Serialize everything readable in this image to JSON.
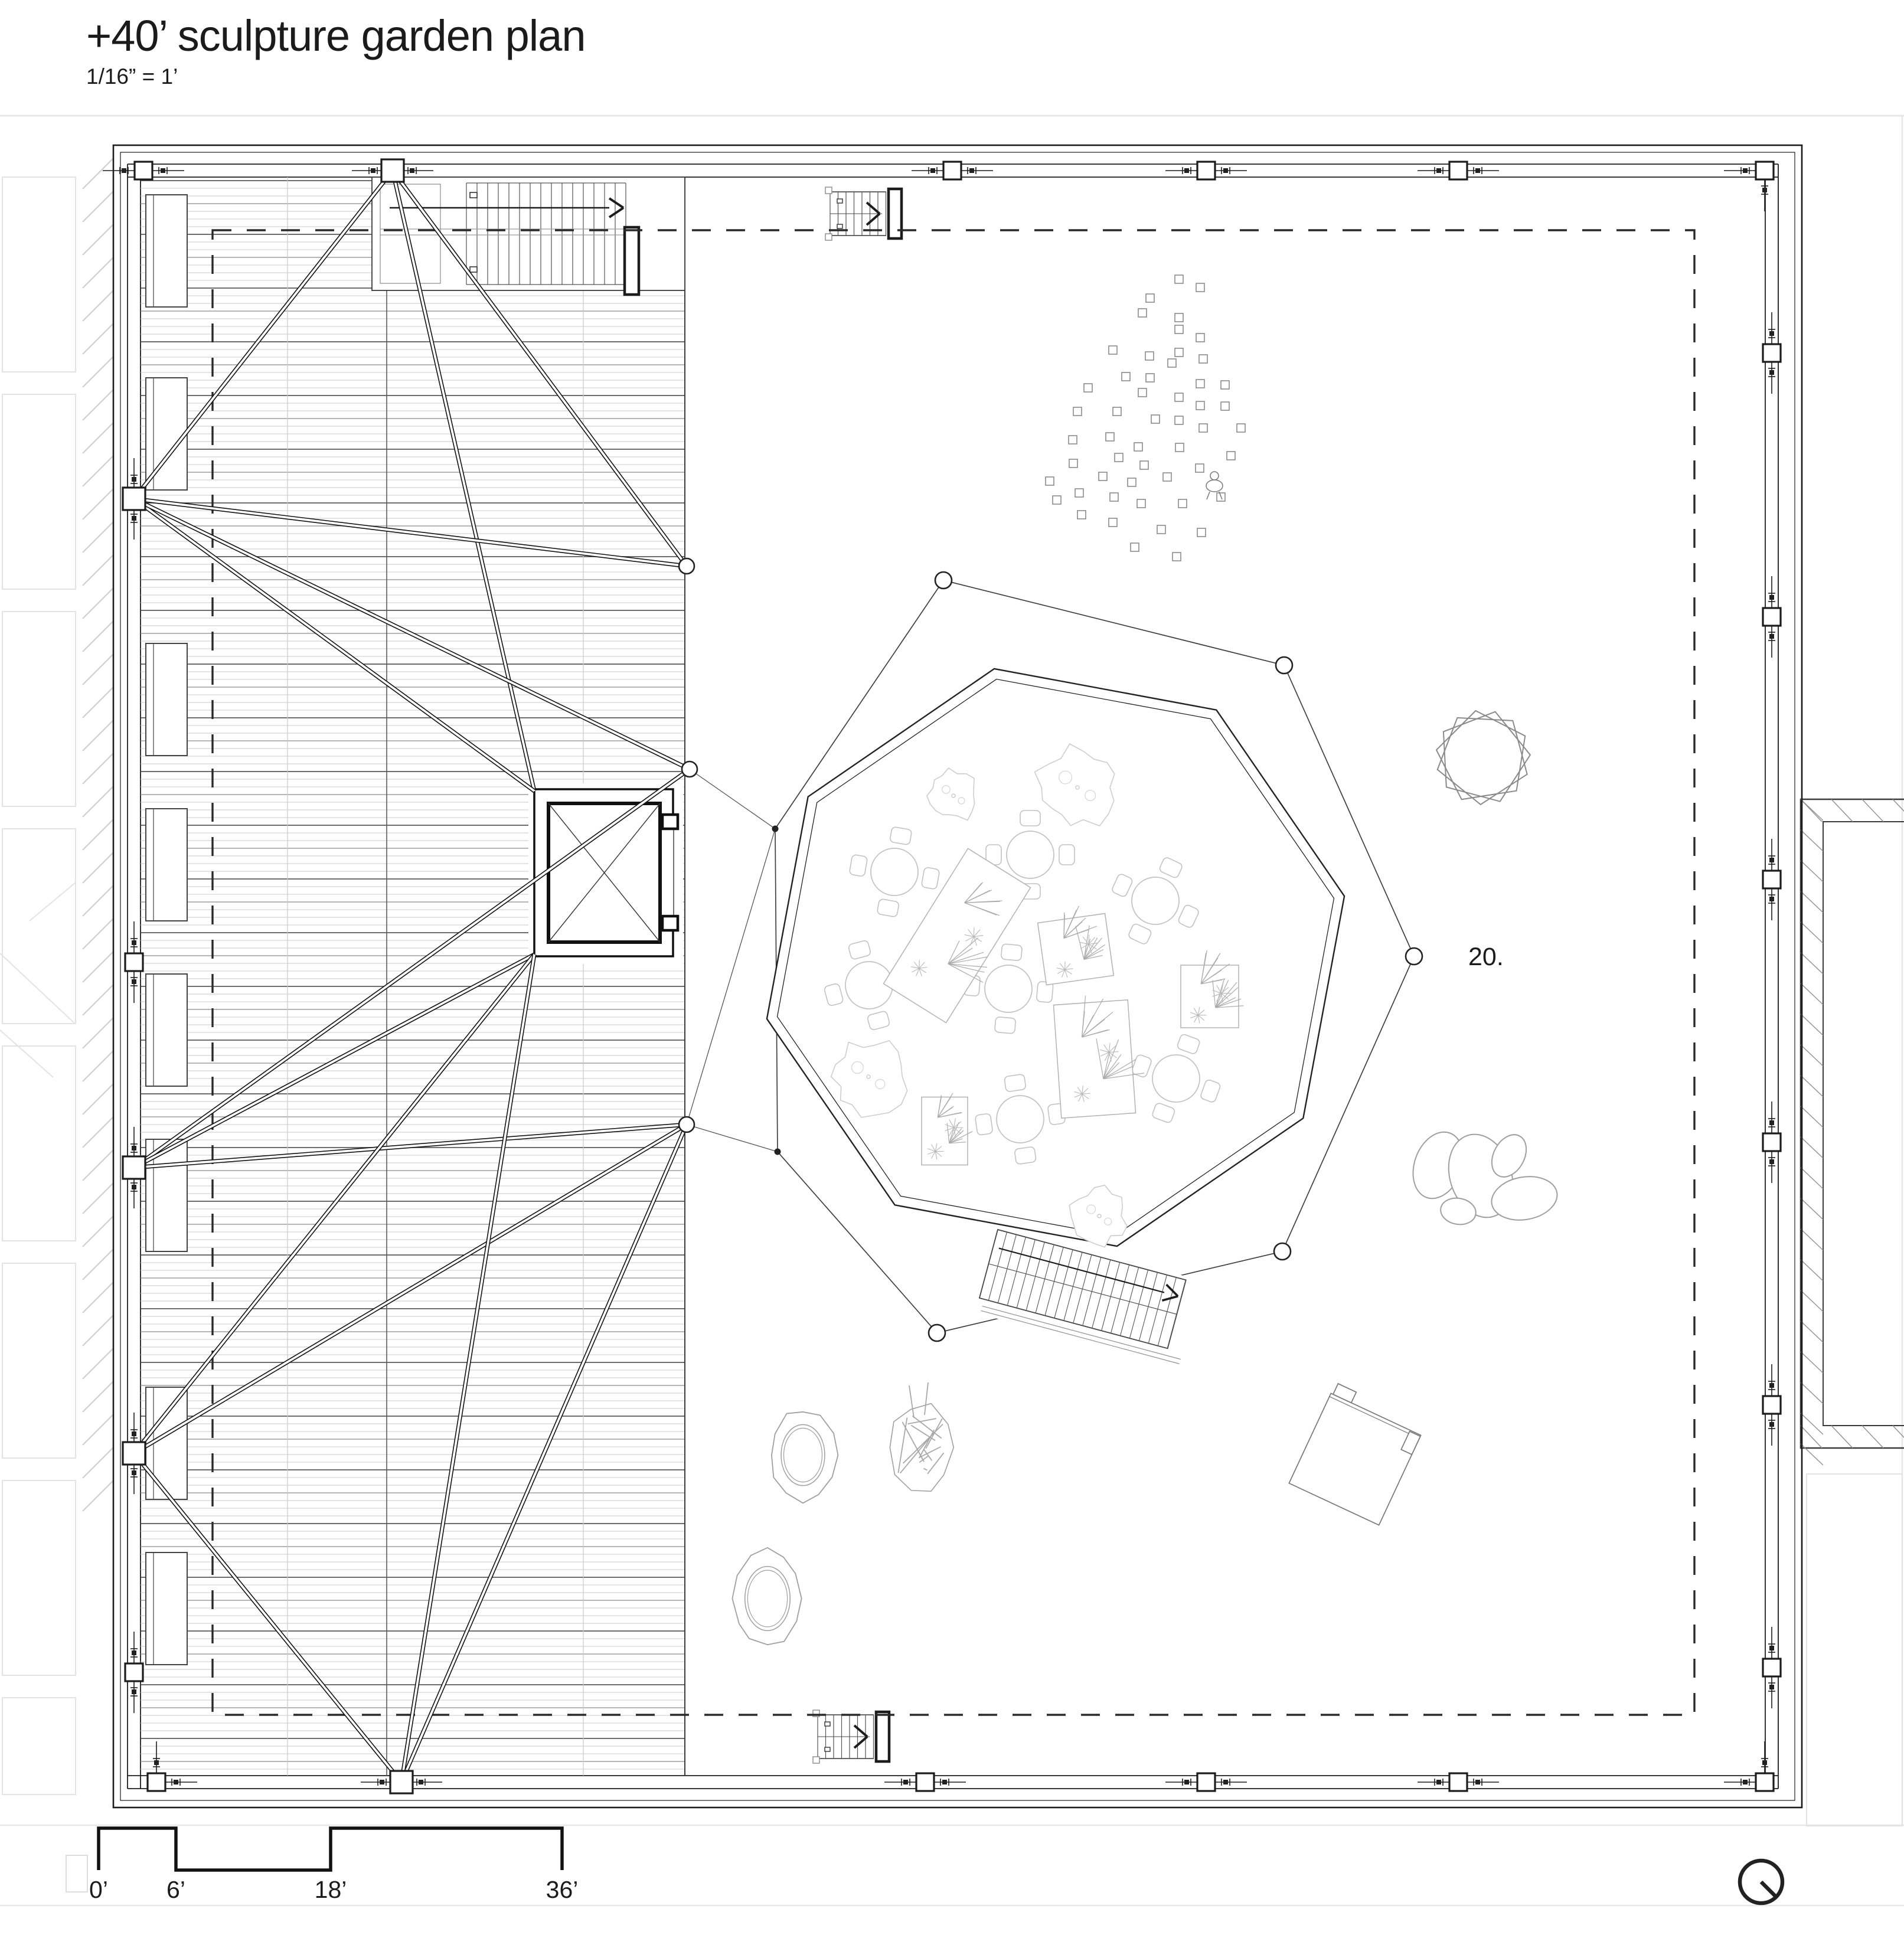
{
  "header": {
    "title": "+40’ sculpture garden plan",
    "scale_note": "1/16” = 1’"
  },
  "plan": {
    "area_label": "20.",
    "elements": {
      "plaza": "octagonal sculpture plaza with cafe tables, planters and trees",
      "deck": "timber roof deck with cable trusses",
      "elevator": "elevator shaft",
      "stairs": "stair with up arrow",
      "north_icon": "north-indicator"
    }
  },
  "scale_bar": {
    "ticks": [
      "0’",
      "6’",
      "18’",
      "36’"
    ]
  },
  "colors": {
    "ink": "#1c1c1c",
    "dark": "#3a3a3a",
    "mid": "#8a8a8a",
    "light": "#c9c9c9",
    "faint": "#e7e7e7",
    "paper": "#ffffff"
  }
}
